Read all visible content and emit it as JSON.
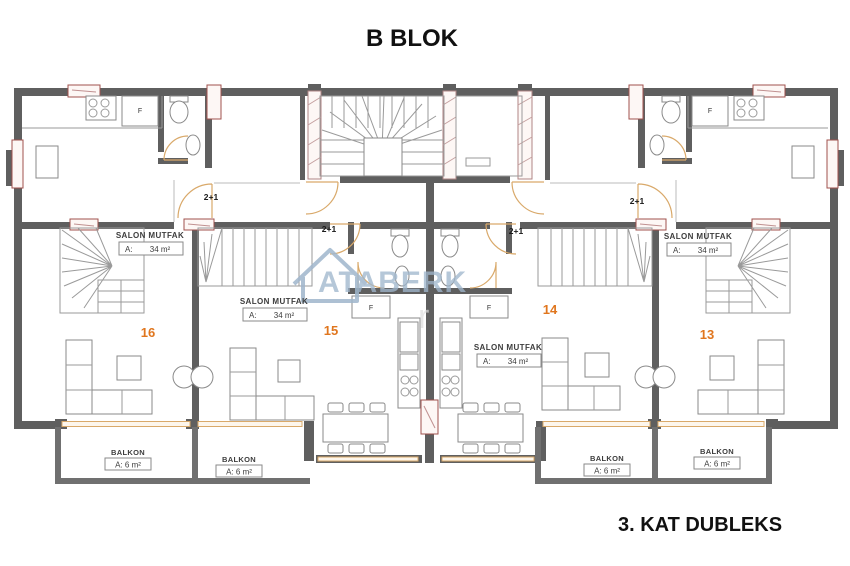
{
  "title": "B BLOK",
  "footer": "3. KAT DUBLEKS",
  "watermark": {
    "text": "ATABERK",
    "partial": "r"
  },
  "labels": {
    "unit_type": "2+1",
    "fridge": "F"
  },
  "units": [
    {
      "number": "16",
      "room": "SALON MUTFAK",
      "area_key": "A:",
      "area_value": "34 m²"
    },
    {
      "number": "15",
      "room": "SALON MUTFAK",
      "area_key": "A:",
      "area_value": "34 m²"
    },
    {
      "number": "14",
      "room": "SALON MUTFAK",
      "area_key": "A:",
      "area_value": "34 m²"
    },
    {
      "number": "13",
      "room": "SALON MUTFAK",
      "area_key": "A:",
      "area_value": "34 m²"
    }
  ],
  "balconies": [
    {
      "label": "BALKON",
      "area": "A: 6 m²"
    },
    {
      "label": "BALKON",
      "area": "A: 6 m²"
    },
    {
      "label": "BALKON",
      "area": "A: 6 m²"
    },
    {
      "label": "BALKON",
      "area": "A: 6 m²"
    }
  ],
  "colors": {
    "wall": "#5f5f5f",
    "balcony_wall": "#707070",
    "door": "#d9a96a",
    "window_frame": "#a0524d",
    "unit_number": "#e0761e",
    "watermark": "#9fb6cc"
  }
}
